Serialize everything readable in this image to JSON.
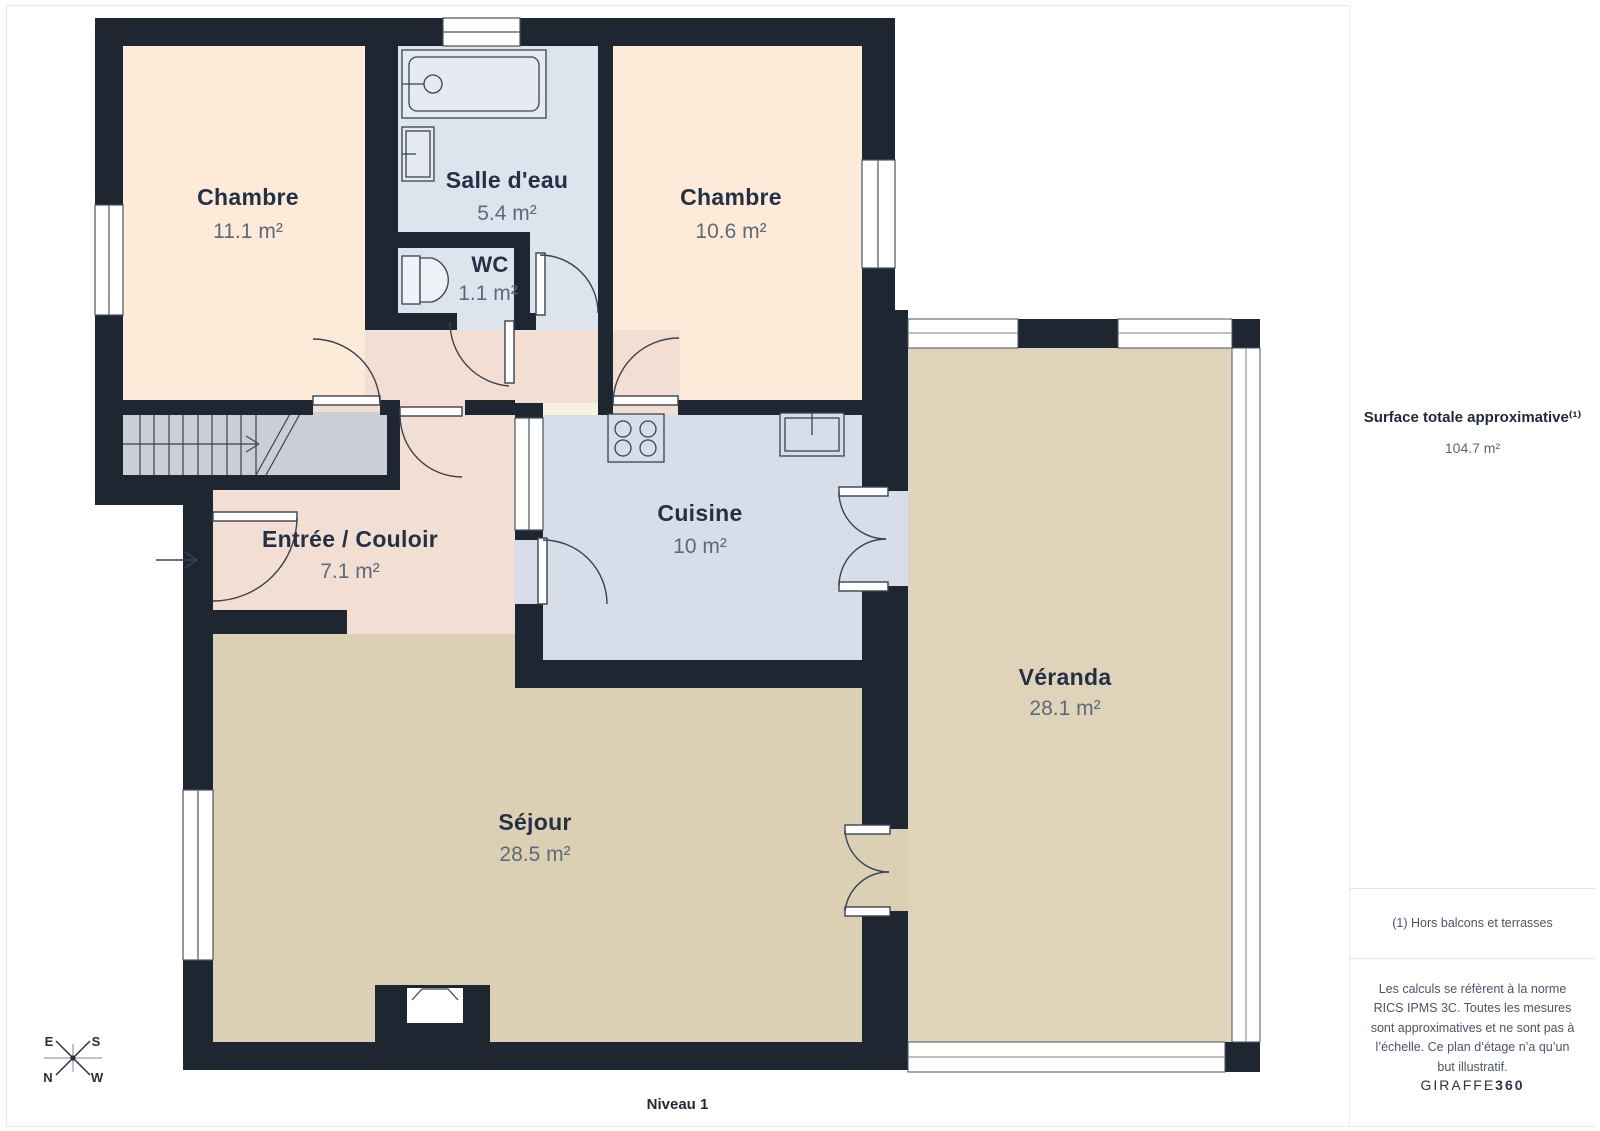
{
  "page": {
    "level_label": "Niveau 1"
  },
  "rooms": [
    {
      "name": "Chambre",
      "area": "11.1 m²"
    },
    {
      "name": "Salle d'eau",
      "area": "5.4 m²"
    },
    {
      "name": "WC",
      "area": "1.1 m²"
    },
    {
      "name": "Chambre",
      "area": "10.6 m²"
    },
    {
      "name": "Entrée / Couloir",
      "area": "7.1 m²"
    },
    {
      "name": "Cuisine",
      "area": "10 m²"
    },
    {
      "name": "Séjour",
      "area": "28.5 m²"
    },
    {
      "name": "Véranda",
      "area": "28.1 m²"
    }
  ],
  "compass": {
    "top_left": "E",
    "top_right": "S",
    "bottom_left": "N",
    "bottom_right": "W"
  },
  "sidebar": {
    "surface_title": "Surface totale approximative⁽¹⁾",
    "surface_value": "104.7 m²",
    "footnote": "(1) Hors balcons et terrasses",
    "disclaimer": "Les calculs se réfèrent à la norme RICS IPMS 3C. Toutes les mesures sont approximatives et ne sont pas à l’échelle. Ce plan d’étage n’a qu’un but illustratif.",
    "brand_name": "GIRAFFE",
    "brand_suffix": "360"
  },
  "colors": {
    "wall": "#1e2632",
    "bedroom": "#fdead9",
    "wet": "#dde4ee",
    "kitchen": "#d7dee9",
    "hall": "#f3ded3",
    "living": "#dcd0b4",
    "veranda": "#dfd4ba",
    "accent_text": "#243044"
  }
}
